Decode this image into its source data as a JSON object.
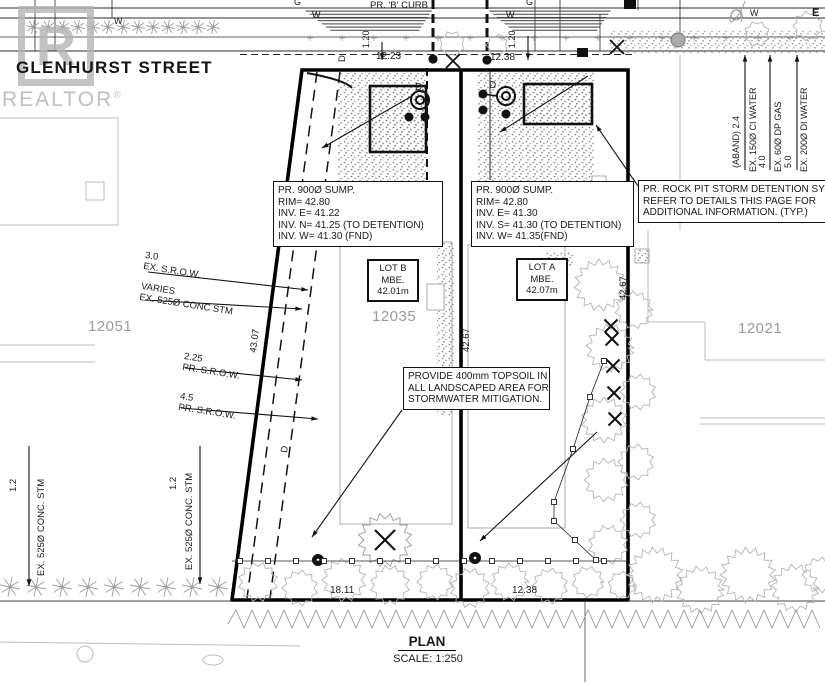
{
  "street": {
    "name": "GLENHURST STREET",
    "curb_label": "PR. 'B' CURB",
    "water_marker": "W",
    "gas_marker": "G",
    "east_marker": "E",
    "drain_marker": "D",
    "dim_frontage_b": "12.23",
    "dim_frontage_a": "12.38",
    "offset_b": "1.20",
    "offset_a": "1.20"
  },
  "watermark": {
    "letter": "R",
    "name": "REALTOR",
    "reg": "®"
  },
  "notes": {
    "sump_b": [
      "PR. 900Ø SUMP.",
      "RIM= 42.80",
      "INV. E= 41.22",
      "INV. N= 41.25 (TO DETENTION)",
      "INV. W=  41.30 (FND)"
    ],
    "sump_a": [
      "PR. 900Ø SUMP.",
      "RIM= 42.80",
      "INV. E= 41.30",
      "INV. S= 41.30 (TO DETENTION)",
      "INV. W=  41.35(FND)"
    ],
    "rock_pit": [
      "PR. ROCK PIT STORM DETENTION SYSTEM",
      "REFER TO DETAILS THIS PAGE FOR",
      "ADDITIONAL INFORMATION. (TYP.)"
    ],
    "topsoil": [
      "PROVIDE 400mm TOPSOIL IN",
      "ALL LANDSCAPED AREA FOR",
      "STORMWATER MITIGATION."
    ]
  },
  "lots": {
    "lot_b": [
      "LOT B",
      "MBE.",
      "42.01m"
    ],
    "lot_a": [
      "LOT A",
      "MBE.",
      "42.07m"
    ],
    "address_west": "12051",
    "address_site": "12035",
    "address_east": "12021"
  },
  "dimensions": {
    "depth_west": "43.07",
    "depth_mid": "42.67",
    "depth_east": "42.67",
    "rear_b": "18.11",
    "rear_a": "12.38"
  },
  "offsets": {
    "ex_srow": {
      "value": "3.0",
      "label": "EX. S.R.O.W."
    },
    "ex_stm": {
      "value": "VARIES",
      "label": "EX. 525Ø CONC STM"
    },
    "pr_srow_1": {
      "value": "2.25",
      "label": "PR. S.R.O.W."
    },
    "pr_srow_2": {
      "value": "4.5",
      "label": "PR. S.R.O.W."
    }
  },
  "west_utilities": {
    "stm_1": {
      "value": "1.2",
      "label": "EX. 525Ø CONC. STM"
    },
    "stm_2": {
      "value": "1.2",
      "label": "EX. 525Ø CONC. STM"
    }
  },
  "east_utilities": [
    {
      "value": "(ABAND) 2.4",
      "label": "EX. 150Ø CI WATER"
    },
    {
      "value": "4.0",
      "label": "EX. 60Ø DP GAS"
    },
    {
      "value": "5.0",
      "label": "EX. 200Ø DI WATER"
    }
  ],
  "footer": {
    "title": "PLAN",
    "scale": "SCALE: 1:250"
  }
}
